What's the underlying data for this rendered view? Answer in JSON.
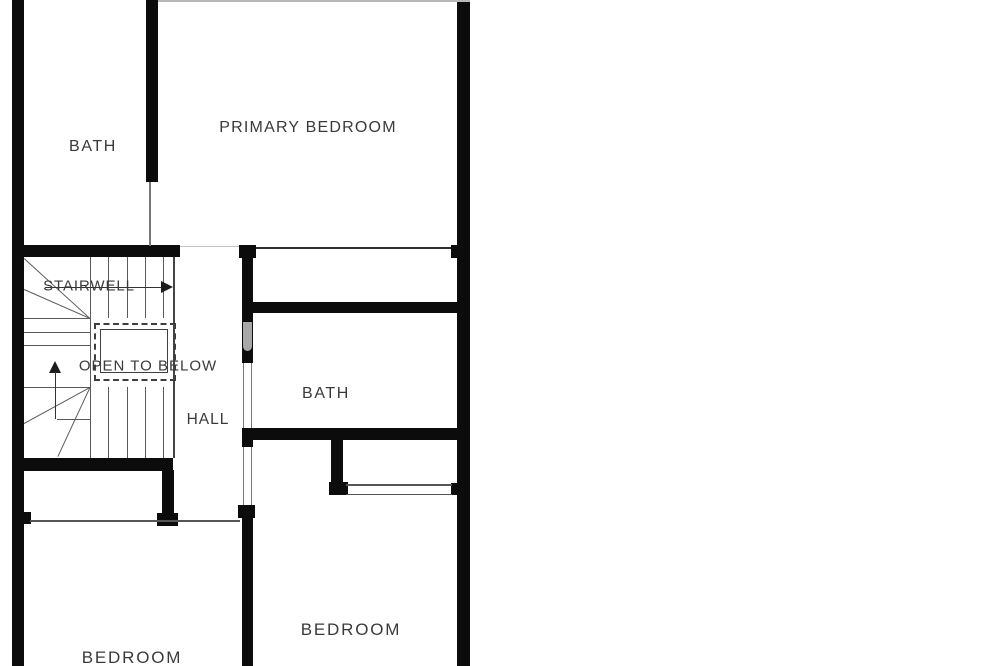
{
  "floorplan": {
    "labels": {
      "bath_upper": "BATH",
      "primary_bedroom": "PRIMARY BEDROOM",
      "stairwell": "STAIRWELL",
      "open_to_below": "OPEN TO BELOW",
      "hall": "HALL",
      "bath_lower": "BATH",
      "bedroom_left": "BEDROOM",
      "bedroom_right": "BEDROOM"
    },
    "colors": {
      "wall": "#0c0c0c",
      "thin_line": "#555555",
      "stair_line": "#5a5a5a",
      "label_text": "#3a3a3a",
      "background": "#ffffff",
      "watermark_artifact": "#a8a8a8"
    }
  }
}
